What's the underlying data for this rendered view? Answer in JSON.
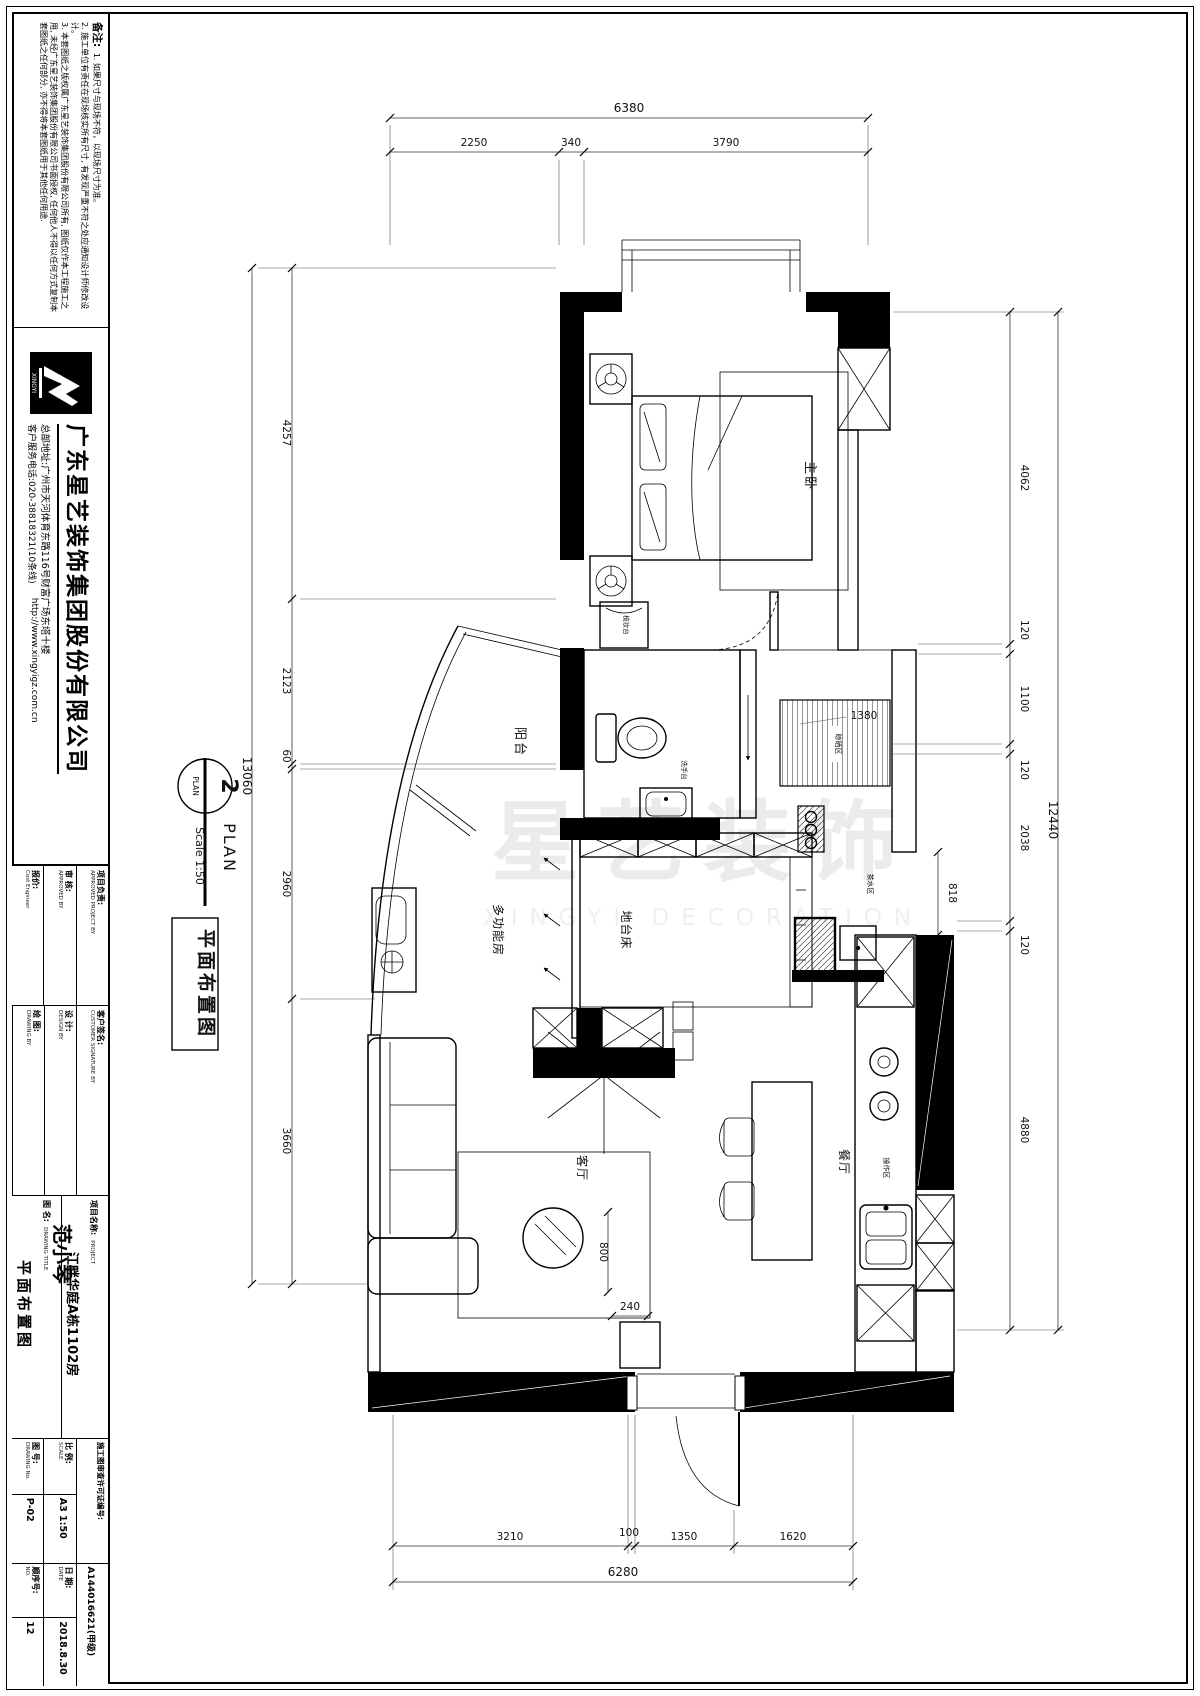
{
  "sheet": {
    "notes": {
      "title": "备注:",
      "lines": [
        "1. 如果尺寸与现场不符，以现场尺寸为准。",
        "2. 施工单位有责任在现场核实所有尺寸, 有发现严重不符之处应通知设计师修改设计。",
        "3. 本套图纸之版权属广东星艺装饰集团股份有限公司所有, 图纸仅作本工程施工之用, 未经广东星艺装饰集团股份有限公司书面授权, 任何他人不得以任何方式复制本套图纸之任何部分, 亦不得将本套图纸用于其他任何用途."
      ]
    },
    "brand": {
      "logo_text": "XINGYI",
      "company": "广东星艺装饰集团股份有限公司",
      "address": "总部地址:广州市天河体育东路116号财富广场东塔十楼",
      "phone": "客户服务电话:020-38818321(10条线)",
      "website": "http://www.xingyigz.com.cn"
    },
    "titleblock": {
      "project_lead_label": "项目负责:",
      "project_lead_en": "APPROVED PROJECT BY",
      "review_label": "审 核:",
      "review_en": "APPROVED BY",
      "cost_label": "报价:",
      "cost_en": "Cost Engineer",
      "customer_label": "客户签名:",
      "customer_en": "CUSTOMER SIGNATURE BY",
      "design_label": "设 计:",
      "design_en": "DESIGN BY",
      "drawing_by_label": "绘 图:",
      "drawing_by_en": "DRAWING BY",
      "drawing_by_value": "范小琴",
      "project_label": "项目名称:",
      "project_en": "PROJECT",
      "project_value": "江畔华庭A栋1102房",
      "title_label": "图 名:",
      "title_en": "DRAWING TITLE",
      "title_value": "平面布置图",
      "permit_label": "施工图审查许可证编号:",
      "permit_value": "A144016621(甲级)",
      "scale_label": "比 例:",
      "scale_en": "SCALE",
      "scale_value": "A3 1:50",
      "date_label": "日 期:",
      "date_en": "DATE",
      "date_value": "2018.8.30",
      "no_label": "图 号:",
      "no_en": "DRAWING No.",
      "no_value": "P-02",
      "seq_label": "顺序号:",
      "seq_en": "NO.",
      "seq_value": "12"
    }
  },
  "plan_marker": {
    "number": "2",
    "label": "PLAN",
    "title": "PLAN",
    "scale": "Scale 1:50",
    "stamp": "平面布置图"
  },
  "watermark": {
    "main": "星艺装饰",
    "sub": "XINGYI DECORATION"
  },
  "rooms": {
    "master": "主卧",
    "balcony": "阳台",
    "multifunction": "多功能房",
    "platform_bed": "地台床",
    "living": "客厅",
    "dining": "餐厅",
    "drying": "晾晒区",
    "tea": "茶水区",
    "work": "操作区"
  },
  "fixtures": {
    "basin": "洗手台",
    "dresser": "梳妆台"
  },
  "dims": {
    "top": {
      "total": "6380",
      "parts": [
        "2250",
        "340",
        "3790"
      ]
    },
    "left": {
      "total": "13060",
      "parts": [
        "4257",
        "2123",
        "60",
        "2960",
        "3660"
      ]
    },
    "right": {
      "total": "12440",
      "parts": [
        "4062",
        "120",
        "1100",
        "120",
        "2038",
        "120",
        "4880"
      ]
    },
    "bottom": {
      "total": "6280",
      "parts": [
        "3210",
        "100",
        "1350",
        "1620"
      ]
    },
    "interior": {
      "drying": "1380",
      "passage": "818",
      "cabinet": "240",
      "walkway": "800"
    }
  }
}
